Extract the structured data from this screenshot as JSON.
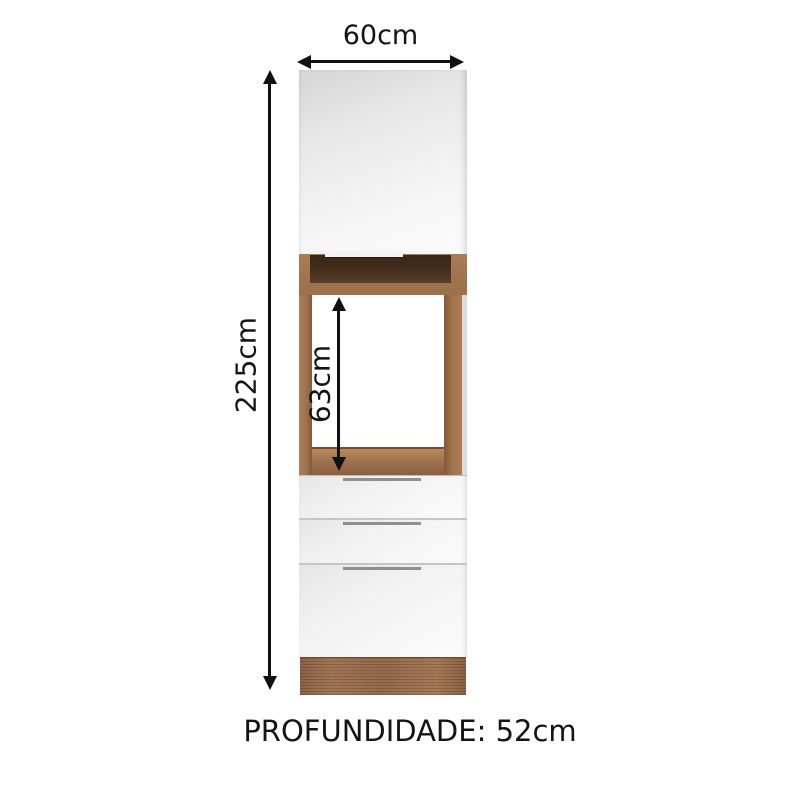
{
  "dimensions": {
    "width_label": "60cm",
    "height_label": "225cm",
    "oven_cavity_label": "63cm",
    "depth_label": "PROFUNDIDADE: 52cm"
  },
  "colors": {
    "line": "#111111",
    "wood": "#a0734e",
    "wood_dark": "#442e1e",
    "wood_base": "#8f6345",
    "panel_edge": "#dcdcdc"
  }
}
